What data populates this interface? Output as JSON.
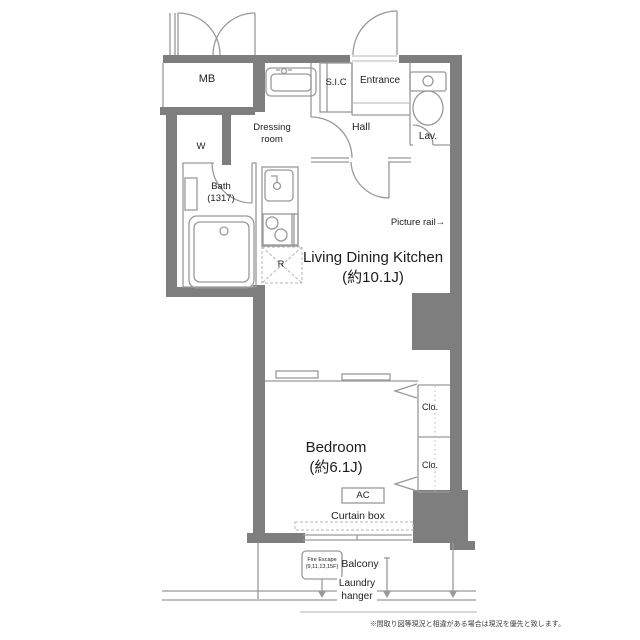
{
  "title": "apartment-floorplan",
  "colors": {
    "wall": "#7e7e7e",
    "line": "#999999",
    "light_line": "#bbbbbb",
    "text": "#222222"
  },
  "labels": {
    "mb": "MB",
    "w": "W",
    "dressing": "Dressing\nroom",
    "sic": "S.I.C",
    "entrance": "Entrance",
    "hall": "Hall",
    "lav": "Lav.",
    "bath": "Bath\n(1317)",
    "fridge": "R",
    "picture_rail": "Picture rail→",
    "ldk": "Living Dining Kitchen\n(約10.1J)",
    "bedroom": "Bedroom\n(約6.1J)",
    "closet_upper": "Clo.",
    "closet_lower": "Clo.",
    "ac": "AC",
    "curtain_box": "Curtain box",
    "fire_escape": "Fire Escape\n(9,11,13,15F)",
    "balcony": "Balcony",
    "laundry": "Laundry\nhanger",
    "disclaimer": "※間取り図等現況と相違がある場合は現況を優先と致します。"
  }
}
